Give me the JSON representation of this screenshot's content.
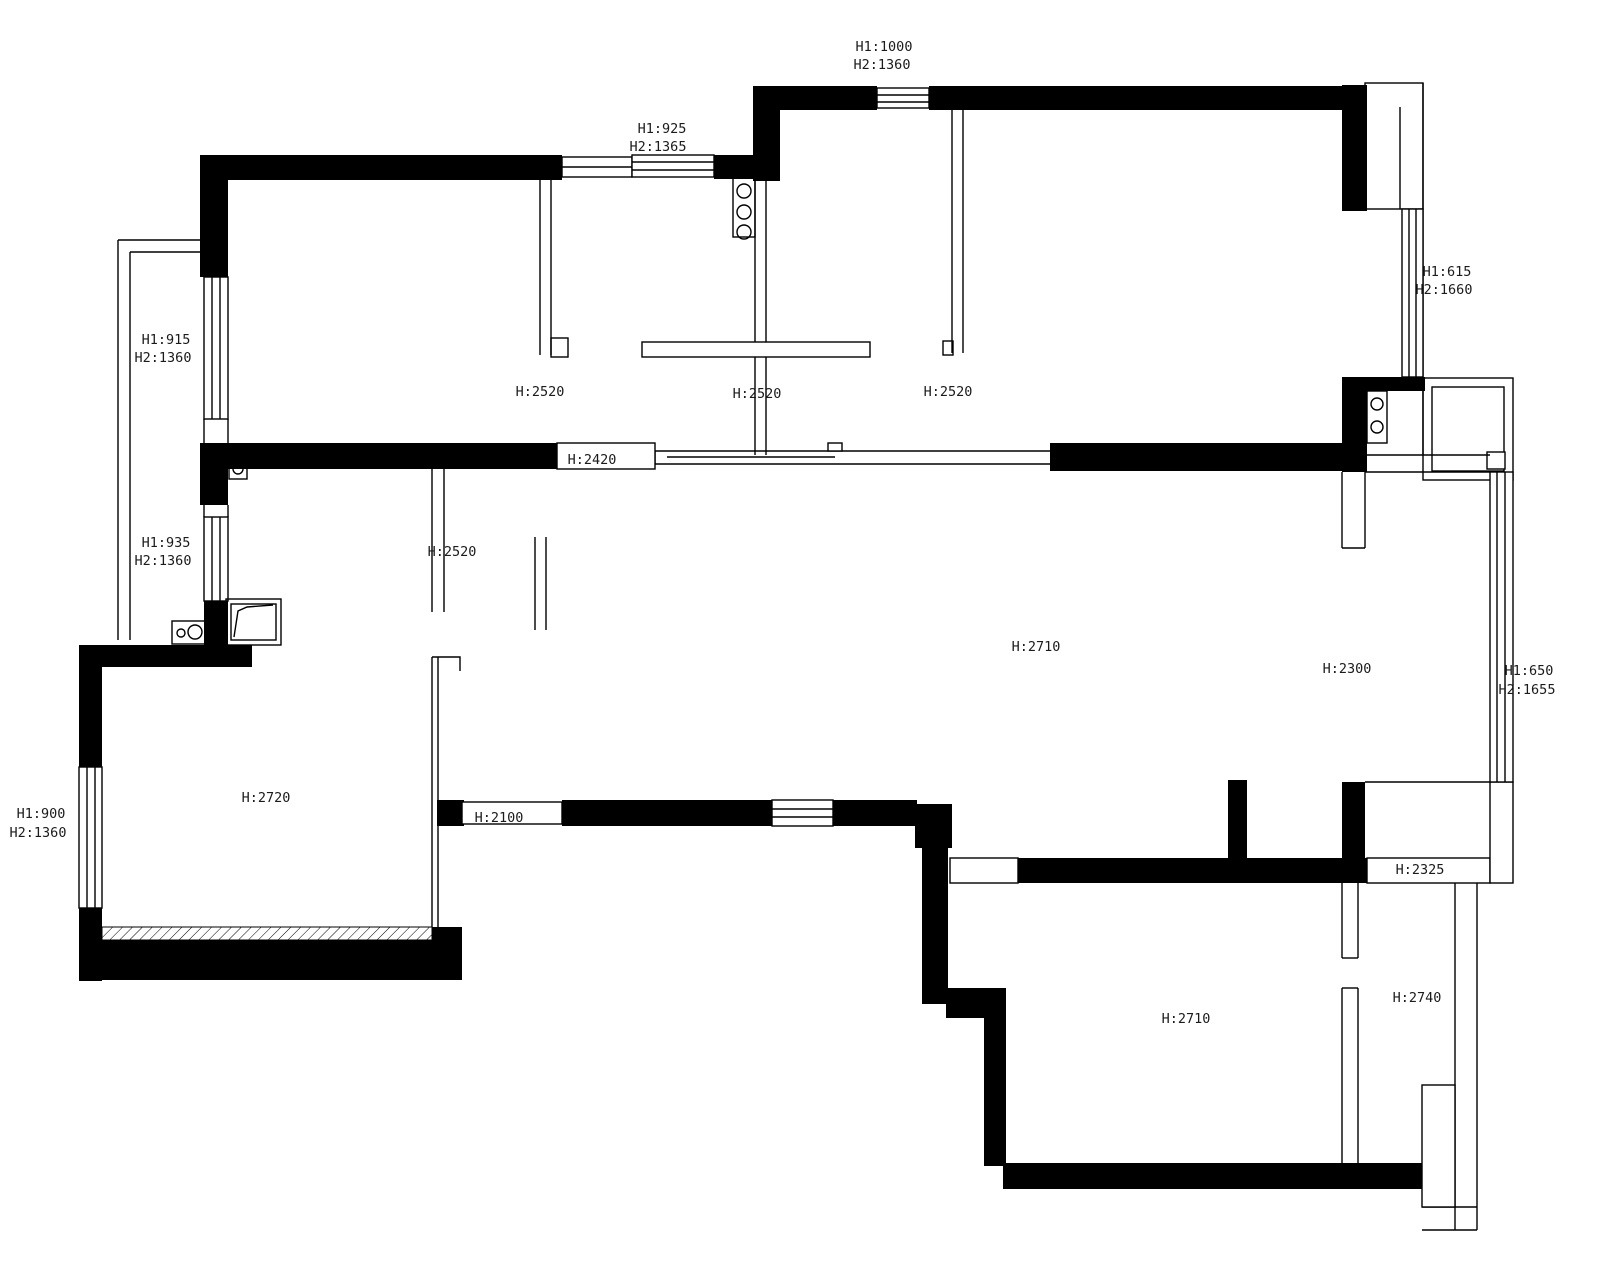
{
  "canvas": {
    "background": "#ffffff",
    "wall_color": "#000000",
    "line_color": "#000000",
    "label_color": "#1b1b1b"
  },
  "dims": {
    "win_top": [
      "H1:1000",
      "H2:1360"
    ],
    "win_kitchen": [
      "H1:925",
      "H2:1365"
    ],
    "win_right_upper": [
      "H1:615",
      "H2:1660"
    ],
    "win_left_upper": [
      "H1:915",
      "H2:1360"
    ],
    "win_left_mid": [
      "H1:935",
      "H2:1360"
    ],
    "win_right_mid": [
      "H1:650",
      "H2:1655"
    ],
    "win_left_lower": [
      "H1:900",
      "H2:1360"
    ],
    "door_bedroom1": "H:2520",
    "door_kitchen": "H:2520",
    "door_bedroom2": "H:2520",
    "open_2420": "H:2420",
    "door_hall": "H:2520",
    "room_living": "H:2710",
    "door_balcony": "H:2300",
    "room_left_lower": "H:2720",
    "open_2100": "H:2100",
    "open_2325": "H:2325",
    "room_right_small": "H:2740",
    "room_bottom": "H:2710"
  },
  "objects": {
    "stove_top": "3-burner-fixture",
    "fixture_right": "2-burner-fixture",
    "meter_box": "meter-box",
    "washer": "washer-fixture",
    "shower_tray": "shower-tray"
  }
}
